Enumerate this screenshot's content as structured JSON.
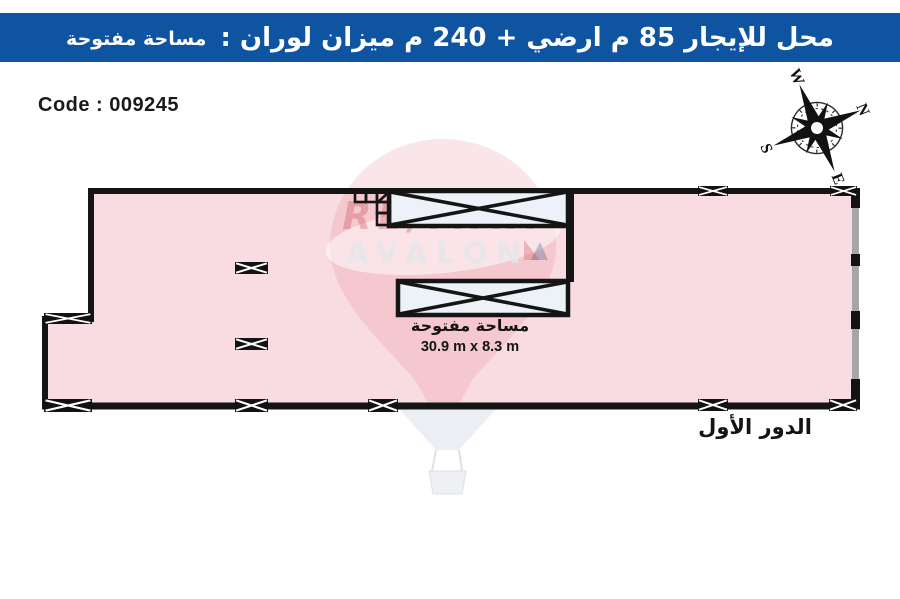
{
  "header": {
    "title": "محل للإيجار 85 م ارضي + 240 م ميزان لوران :",
    "subtitle": "مساحة مفتوحة",
    "bg_color": "#0f54a0",
    "text_color": "#ffffff"
  },
  "code_label": "Code : 009245",
  "compass": {
    "rotation_deg": 68,
    "letters": {
      "n": "N",
      "e": "E",
      "s": "S",
      "w": "W"
    }
  },
  "plan": {
    "fill_color": "#f8dce1",
    "wall_color": "#151515",
    "glass_wall_color": "#a6a6a6",
    "skylight_fill": "#edf2f8",
    "area_label": "مساحة مفتوحة",
    "area_dimensions": "30.9 m x 8.3 m",
    "floor_label": "الدور الأول"
  },
  "watermark": {
    "brand": "RE/MAX",
    "name": "AVALON"
  }
}
